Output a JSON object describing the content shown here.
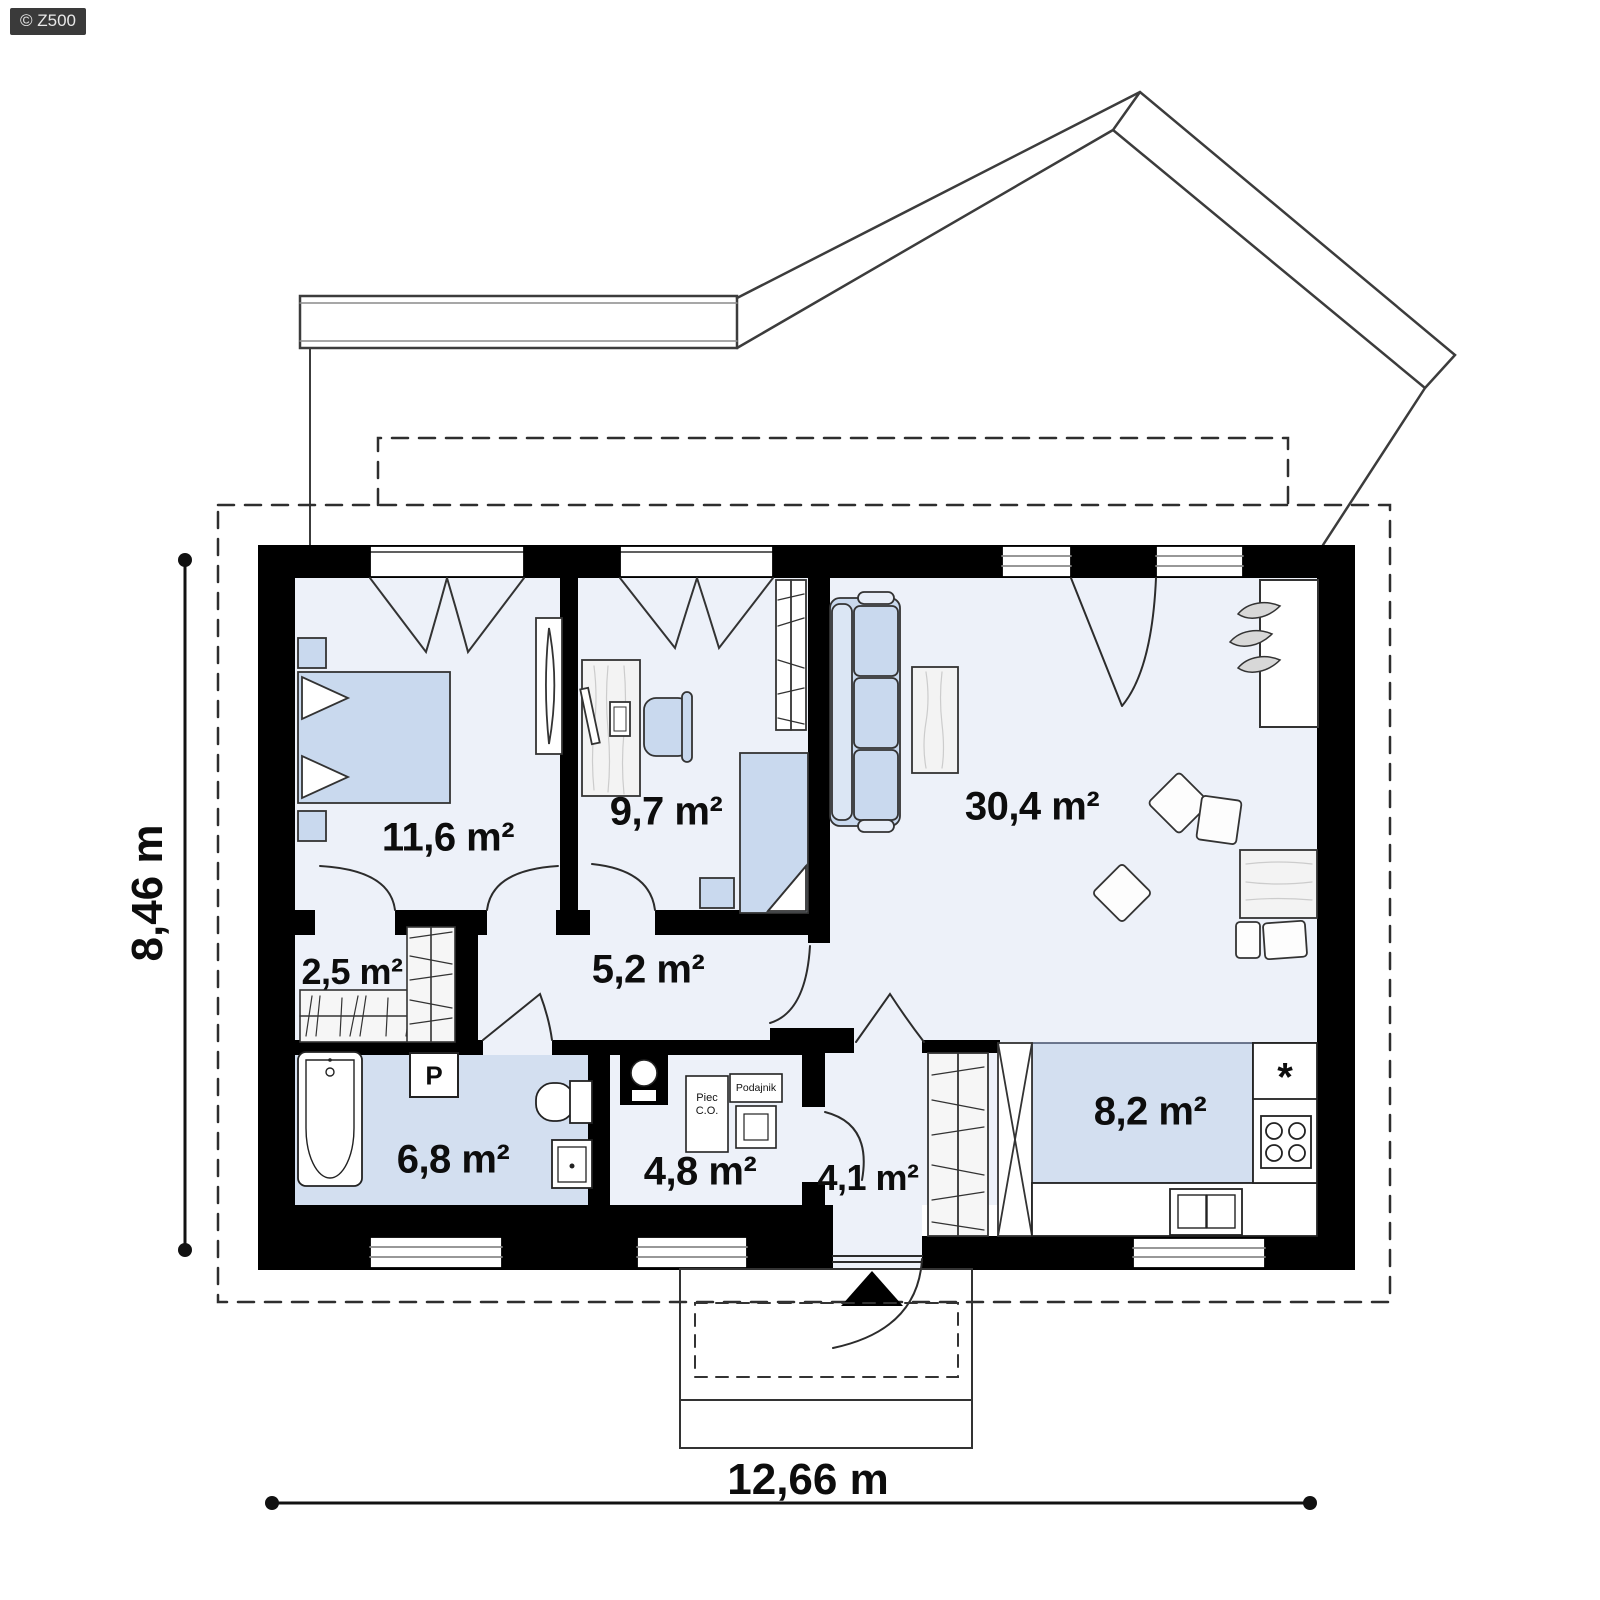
{
  "watermark": "© Z500",
  "rooms": {
    "bedroom": {
      "area_label": "11,6 m²"
    },
    "kids_room": {
      "area_label": "9,7 m²"
    },
    "living_room": {
      "area_label": "30,4 m²"
    },
    "wardrobe": {
      "area_label": "2,5 m²"
    },
    "hallway": {
      "area_label": "5,2 m²"
    },
    "bathroom": {
      "area_label": "6,8 m²"
    },
    "boiler_room": {
      "area_label": "4,8 m²"
    },
    "entry": {
      "area_label": "4,1 m²"
    },
    "kitchen": {
      "area_label": "8,2 m²"
    }
  },
  "dimensions": {
    "total_width_label": "12,66 m",
    "total_height_label": "8,46 m"
  },
  "equipment": {
    "washing_machine_label": "P",
    "furnace_label": "Piec C.O.",
    "feeder_label": "Podajnik",
    "sink_marker": "*"
  },
  "colors": {
    "wall": "#000000",
    "floor_light": "#edf1f9",
    "floor_wet": "#d3dff0",
    "furniture_blue": "#c9d9ee",
    "wood": "#f3f3f3",
    "roof_line": "#3c3c3c",
    "watermark_bg": "#3a3a3a"
  }
}
